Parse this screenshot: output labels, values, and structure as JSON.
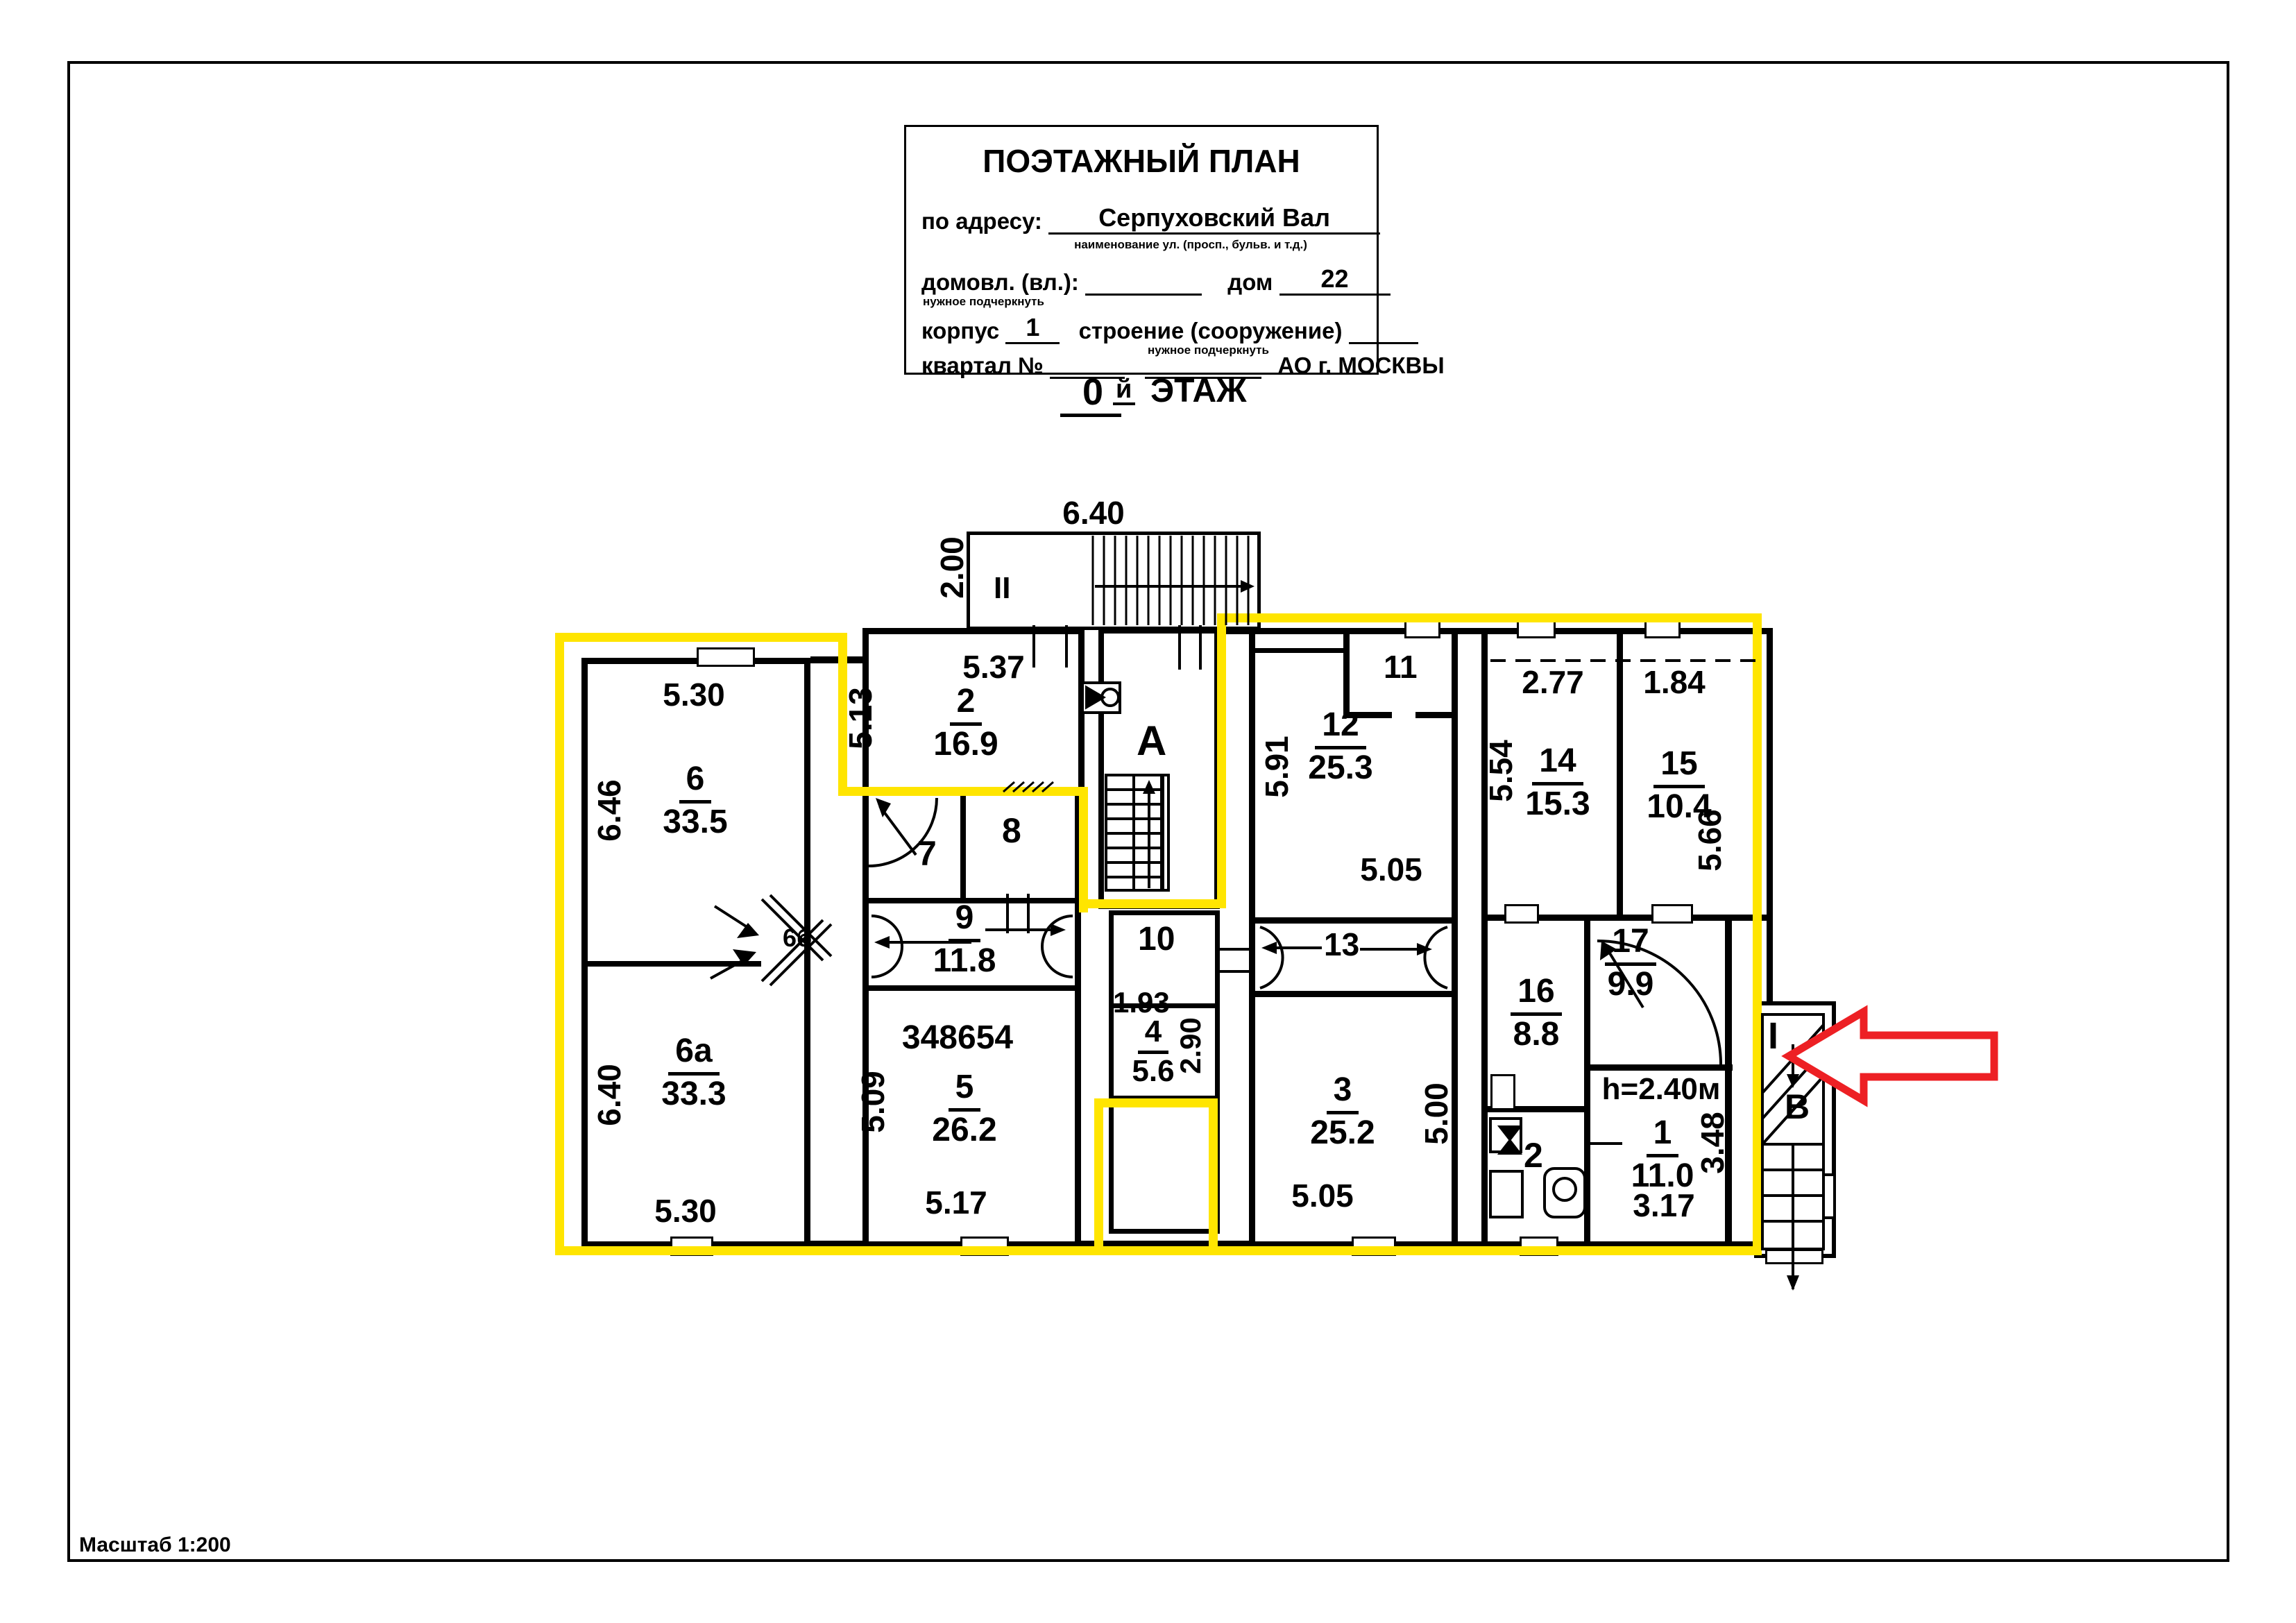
{
  "title_block": {
    "title": "ПОЭТАЖНЫЙ ПЛАН",
    "address_label": "по адресу:",
    "address_value": "Серпуховский Вал",
    "address_hint": "наименование ул. (просп., бульв. и т.д.)",
    "ownership_label": "домовл. (вл.):",
    "underline_hint": "нужное подчеркнуть",
    "house_label": "дом",
    "house_value": "22",
    "block_label": "корпус",
    "block_value": "1",
    "structure_label": "строение (сооружение)",
    "structure_hint": "нужное подчеркнуть",
    "quarter_label": "квартал №",
    "okrug_label": "АО г. МОСКВЫ"
  },
  "floor_label": {
    "number": "0",
    "suffix": "й",
    "word": "ЭТАЖ"
  },
  "scale_note": "Масштаб 1:200",
  "stamps": {
    "inventory_number": "348654"
  },
  "stairs": {
    "vestibule": "II",
    "hall": "A",
    "entry": "I",
    "stairwell": "В"
  },
  "vestibule_dims": {
    "width": "6.40",
    "depth": "2.00"
  },
  "rooms": {
    "r6": {
      "num": "6",
      "area": "33.5",
      "dim_top": "5.30",
      "dim_left": "6.46"
    },
    "r6a": {
      "num": "6а",
      "area": "33.3",
      "dim_left": "6.40",
      "dim_bottom": "5.30"
    },
    "r6b": {
      "num": "6б"
    },
    "r2": {
      "num": "2",
      "area": "16.9",
      "dim_top": "5.37",
      "dim_left": "5.13"
    },
    "r7": {
      "num": "7"
    },
    "r8": {
      "num": "8"
    },
    "r9": {
      "num": "9",
      "area": "11.8"
    },
    "r5": {
      "num": "5",
      "area": "26.2",
      "dim_left": "5.09",
      "dim_bottom": "5.17"
    },
    "r10": {
      "num": "10"
    },
    "r4": {
      "num": "4",
      "area": "5.6",
      "dim_top": "1.93",
      "dim_right": "2.90"
    },
    "r11": {
      "num": "11"
    },
    "r12": {
      "num": "12",
      "area": "25.3",
      "dim_left": "5.91",
      "dim_bottom": "5.05"
    },
    "r13": {
      "num": "13"
    },
    "r3": {
      "num": "3",
      "area": "25.2",
      "dim_right": "5.00",
      "dim_bottom": "5.05"
    },
    "r14": {
      "num": "14",
      "area": "15.3",
      "dim_top": "2.77",
      "dim_left": "5.54"
    },
    "r15": {
      "num": "15",
      "area": "10.4",
      "dim_top": "1.84",
      "dim_right": "5.66"
    },
    "r16": {
      "num": "16",
      "area": "8.8"
    },
    "r17": {
      "num": "17",
      "area": "9.9"
    },
    "r1": {
      "num": "1",
      "area": "11.0",
      "dim_right": "3.48",
      "dim_bottom": "3.17",
      "ceiling": "h=2.40м"
    },
    "rwc": {
      "num": "2"
    }
  },
  "colors": {
    "highlight": "#ffe500",
    "arrow_red": "#ed2024"
  }
}
